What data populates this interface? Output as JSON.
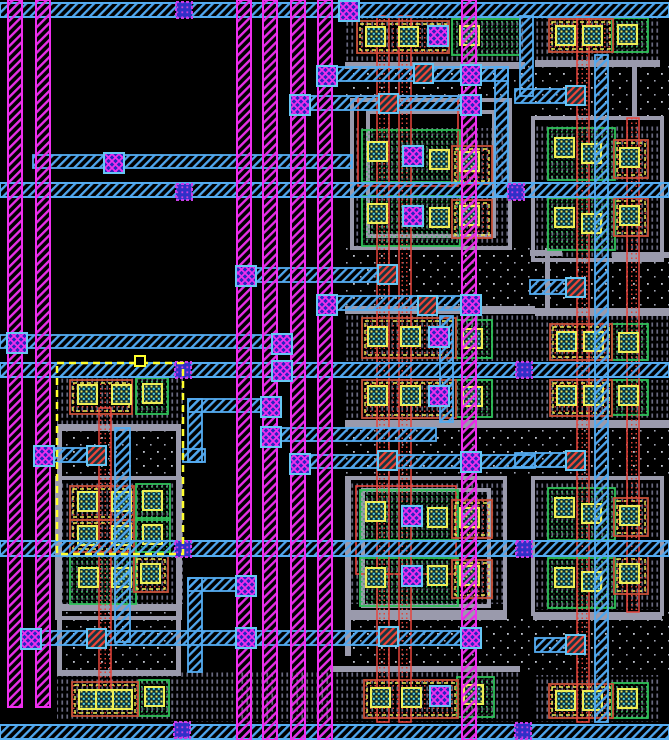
{
  "canvas": {
    "w": 669,
    "h": 740,
    "bg": "#000000"
  },
  "colors": {
    "m1": "#55ACF0",
    "m2": "#EE2EEE",
    "poly": "#E8453C",
    "polyBox": "#C85038",
    "green": "#2EC058",
    "gray": "#9A9AAC",
    "yellow": "#EEEE55",
    "stipple": "#68687E",
    "nwellDot": "#C0C4CE",
    "viaXFill": "#2626BE",
    "viaBorder": "#66C6F4",
    "blueViaFill": "#3030C8",
    "blueViaBorder": "#C83CE8",
    "redContactBase": "#123642",
    "selection": "#FFFF2E"
  },
  "layers": {
    "nwell_regions": [
      {
        "x": 55,
        "y": 430,
        "w": 130,
        "h": 48
      },
      {
        "x": 55,
        "y": 612,
        "w": 130,
        "h": 60
      },
      {
        "x": 345,
        "y": 64,
        "w": 190,
        "h": 36
      },
      {
        "x": 345,
        "y": 248,
        "w": 190,
        "h": 58
      },
      {
        "x": 345,
        "y": 428,
        "w": 190,
        "h": 50
      },
      {
        "x": 345,
        "y": 618,
        "w": 190,
        "h": 54
      },
      {
        "x": 535,
        "y": 64,
        "w": 134,
        "h": 54
      },
      {
        "x": 535,
        "y": 260,
        "w": 134,
        "h": 56
      },
      {
        "x": 535,
        "y": 424,
        "w": 134,
        "h": 54
      },
      {
        "x": 535,
        "y": 612,
        "w": 134,
        "h": 60
      }
    ],
    "stipple_regions": [
      {
        "x": 345,
        "y": 16,
        "w": 180,
        "h": 46
      },
      {
        "x": 535,
        "y": 16,
        "w": 125,
        "h": 46
      },
      {
        "x": 352,
        "y": 128,
        "w": 158,
        "h": 56
      },
      {
        "x": 352,
        "y": 196,
        "w": 158,
        "h": 50
      },
      {
        "x": 533,
        "y": 126,
        "w": 129,
        "h": 58
      },
      {
        "x": 533,
        "y": 196,
        "w": 129,
        "h": 62
      },
      {
        "x": 57,
        "y": 377,
        "w": 126,
        "h": 47
      },
      {
        "x": 345,
        "y": 314,
        "w": 190,
        "h": 47
      },
      {
        "x": 345,
        "y": 380,
        "w": 190,
        "h": 40
      },
      {
        "x": 535,
        "y": 316,
        "w": 134,
        "h": 45
      },
      {
        "x": 535,
        "y": 380,
        "w": 134,
        "h": 44
      },
      {
        "x": 57,
        "y": 482,
        "w": 126,
        "h": 58
      },
      {
        "x": 57,
        "y": 556,
        "w": 126,
        "h": 48
      },
      {
        "x": 347,
        "y": 482,
        "w": 158,
        "h": 57
      },
      {
        "x": 347,
        "y": 558,
        "w": 158,
        "h": 46
      },
      {
        "x": 533,
        "y": 482,
        "w": 129,
        "h": 57
      },
      {
        "x": 533,
        "y": 558,
        "w": 129,
        "h": 52
      },
      {
        "x": 57,
        "y": 676,
        "w": 126,
        "h": 44
      },
      {
        "x": 170,
        "y": 672,
        "w": 350,
        "h": 50
      },
      {
        "x": 535,
        "y": 675,
        "w": 125,
        "h": 47
      }
    ],
    "gray_bars": [
      {
        "x": 345,
        "y": 62,
        "w": 180,
        "h": 7
      },
      {
        "x": 535,
        "y": 60,
        "w": 125,
        "h": 7
      },
      {
        "x": 58,
        "y": 424,
        "w": 120,
        "h": 7
      },
      {
        "x": 345,
        "y": 306,
        "w": 190,
        "h": 8
      },
      {
        "x": 535,
        "y": 308,
        "w": 134,
        "h": 8
      },
      {
        "x": 345,
        "y": 420,
        "w": 190,
        "h": 8
      },
      {
        "x": 535,
        "y": 420,
        "w": 134,
        "h": 8
      },
      {
        "x": 58,
        "y": 604,
        "w": 120,
        "h": 7
      },
      {
        "x": 347,
        "y": 610,
        "w": 158,
        "h": 8
      },
      {
        "x": 533,
        "y": 612,
        "w": 129,
        "h": 8
      },
      {
        "x": 58,
        "y": 670,
        "w": 120,
        "h": 6
      },
      {
        "x": 330,
        "y": 666,
        "w": 190,
        "h": 6
      },
      {
        "x": 57,
        "y": 424,
        "w": 5,
        "h": 252
      },
      {
        "x": 176,
        "y": 424,
        "w": 5,
        "h": 252
      },
      {
        "x": 345,
        "y": 478,
        "w": 6,
        "h": 178
      },
      {
        "x": 612,
        "y": 252,
        "w": 57,
        "h": 6
      },
      {
        "x": 530,
        "y": 250,
        "w": 32,
        "h": 6
      },
      {
        "x": 545,
        "y": 248,
        "w": 5,
        "h": 62
      },
      {
        "x": 632,
        "y": 62,
        "w": 5,
        "h": 56
      }
    ],
    "gray_rects": [
      {
        "x": 352,
        "y": 100,
        "w": 158,
        "h": 148
      },
      {
        "x": 368,
        "y": 112,
        "w": 126,
        "h": 124
      },
      {
        "x": 347,
        "y": 478,
        "w": 158,
        "h": 140
      },
      {
        "x": 363,
        "y": 490,
        "w": 126,
        "h": 116
      },
      {
        "x": 533,
        "y": 118,
        "w": 129,
        "h": 142
      },
      {
        "x": 533,
        "y": 478,
        "w": 129,
        "h": 136
      },
      {
        "x": 57,
        "y": 478,
        "w": 123,
        "h": 140
      }
    ],
    "poly_rects": [
      {
        "x": 358,
        "y": 96,
        "w": 100,
        "h": 90
      },
      {
        "x": 356,
        "y": 486,
        "w": 100,
        "h": 88
      }
    ],
    "green_boxes": [
      {
        "x": 452,
        "y": 19,
        "w": 68,
        "h": 36
      },
      {
        "x": 612,
        "y": 18,
        "w": 36,
        "h": 34
      },
      {
        "x": 362,
        "y": 130,
        "w": 98,
        "h": 52
      },
      {
        "x": 362,
        "y": 196,
        "w": 98,
        "h": 50
      },
      {
        "x": 548,
        "y": 128,
        "w": 67,
        "h": 52
      },
      {
        "x": 548,
        "y": 198,
        "w": 67,
        "h": 52
      },
      {
        "x": 456,
        "y": 320,
        "w": 36,
        "h": 38
      },
      {
        "x": 456,
        "y": 380,
        "w": 36,
        "h": 37
      },
      {
        "x": 612,
        "y": 324,
        "w": 36,
        "h": 36
      },
      {
        "x": 612,
        "y": 380,
        "w": 36,
        "h": 35
      },
      {
        "x": 360,
        "y": 490,
        "w": 98,
        "h": 50
      },
      {
        "x": 360,
        "y": 558,
        "w": 98,
        "h": 48
      },
      {
        "x": 548,
        "y": 488,
        "w": 67,
        "h": 52
      },
      {
        "x": 548,
        "y": 558,
        "w": 67,
        "h": 50
      },
      {
        "x": 457,
        "y": 677,
        "w": 37,
        "h": 40
      },
      {
        "x": 612,
        "y": 683,
        "w": 36,
        "h": 35
      },
      {
        "x": 136,
        "y": 378,
        "w": 32,
        "h": 36
      },
      {
        "x": 136,
        "y": 484,
        "w": 34,
        "h": 36
      },
      {
        "x": 136,
        "y": 518,
        "w": 34,
        "h": 34
      },
      {
        "x": 70,
        "y": 556,
        "w": 66,
        "h": 48
      },
      {
        "x": 139,
        "y": 680,
        "w": 30,
        "h": 36
      }
    ],
    "orange_boxes": [
      {
        "x": 357,
        "y": 21,
        "w": 92,
        "h": 32
      },
      {
        "x": 549,
        "y": 19,
        "w": 64,
        "h": 33
      },
      {
        "x": 452,
        "y": 146,
        "w": 40,
        "h": 38
      },
      {
        "x": 452,
        "y": 200,
        "w": 40,
        "h": 38
      },
      {
        "x": 614,
        "y": 140,
        "w": 34,
        "h": 38
      },
      {
        "x": 614,
        "y": 198,
        "w": 34,
        "h": 38
      },
      {
        "x": 362,
        "y": 318,
        "w": 94,
        "h": 40
      },
      {
        "x": 362,
        "y": 380,
        "w": 94,
        "h": 38
      },
      {
        "x": 550,
        "y": 324,
        "w": 62,
        "h": 36
      },
      {
        "x": 550,
        "y": 380,
        "w": 62,
        "h": 36
      },
      {
        "x": 452,
        "y": 500,
        "w": 40,
        "h": 38
      },
      {
        "x": 452,
        "y": 560,
        "w": 40,
        "h": 38
      },
      {
        "x": 614,
        "y": 498,
        "w": 34,
        "h": 38
      },
      {
        "x": 614,
        "y": 556,
        "w": 34,
        "h": 38
      },
      {
        "x": 364,
        "y": 680,
        "w": 94,
        "h": 38
      },
      {
        "x": 549,
        "y": 684,
        "w": 64,
        "h": 34
      },
      {
        "x": 70,
        "y": 380,
        "w": 62,
        "h": 34
      },
      {
        "x": 70,
        "y": 486,
        "w": 64,
        "h": 34
      },
      {
        "x": 70,
        "y": 520,
        "w": 64,
        "h": 32
      },
      {
        "x": 134,
        "y": 556,
        "w": 34,
        "h": 36
      },
      {
        "x": 72,
        "y": 682,
        "w": 66,
        "h": 34
      }
    ],
    "poly_verticals": [
      {
        "x": 99,
        "y": 408,
        "h": 288
      },
      {
        "x": 377,
        "y": 16,
        "h": 706
      },
      {
        "x": 399,
        "y": 16,
        "h": 706
      },
      {
        "x": 577,
        "y": 16,
        "h": 706
      },
      {
        "x": 627,
        "y": 118,
        "h": 494
      }
    ],
    "contacts": [
      {
        "x": 366,
        "y": 27
      },
      {
        "x": 399,
        "y": 27
      },
      {
        "x": 460,
        "y": 26
      },
      {
        "x": 556,
        "y": 26
      },
      {
        "x": 583,
        "y": 26
      },
      {
        "x": 618,
        "y": 25
      },
      {
        "x": 368,
        "y": 142
      },
      {
        "x": 430,
        "y": 150
      },
      {
        "x": 460,
        "y": 152
      },
      {
        "x": 368,
        "y": 204
      },
      {
        "x": 430,
        "y": 208
      },
      {
        "x": 460,
        "y": 206
      },
      {
        "x": 555,
        "y": 138
      },
      {
        "x": 582,
        "y": 144
      },
      {
        "x": 620,
        "y": 148
      },
      {
        "x": 555,
        "y": 208
      },
      {
        "x": 582,
        "y": 214
      },
      {
        "x": 620,
        "y": 206
      },
      {
        "x": 368,
        "y": 327
      },
      {
        "x": 401,
        "y": 327
      },
      {
        "x": 463,
        "y": 329
      },
      {
        "x": 368,
        "y": 386
      },
      {
        "x": 401,
        "y": 386
      },
      {
        "x": 463,
        "y": 387
      },
      {
        "x": 557,
        "y": 332
      },
      {
        "x": 584,
        "y": 332
      },
      {
        "x": 619,
        "y": 333
      },
      {
        "x": 557,
        "y": 386
      },
      {
        "x": 584,
        "y": 386
      },
      {
        "x": 619,
        "y": 386
      },
      {
        "x": 366,
        "y": 502
      },
      {
        "x": 428,
        "y": 508
      },
      {
        "x": 460,
        "y": 508
      },
      {
        "x": 366,
        "y": 568
      },
      {
        "x": 428,
        "y": 566
      },
      {
        "x": 460,
        "y": 566
      },
      {
        "x": 555,
        "y": 498
      },
      {
        "x": 582,
        "y": 504
      },
      {
        "x": 620,
        "y": 506
      },
      {
        "x": 555,
        "y": 568
      },
      {
        "x": 582,
        "y": 572
      },
      {
        "x": 620,
        "y": 564
      },
      {
        "x": 371,
        "y": 688
      },
      {
        "x": 402,
        "y": 688
      },
      {
        "x": 464,
        "y": 685
      },
      {
        "x": 556,
        "y": 691
      },
      {
        "x": 583,
        "y": 691
      },
      {
        "x": 618,
        "y": 689
      },
      {
        "x": 78,
        "y": 385
      },
      {
        "x": 112,
        "y": 385
      },
      {
        "x": 143,
        "y": 384
      },
      {
        "x": 78,
        "y": 492
      },
      {
        "x": 112,
        "y": 492
      },
      {
        "x": 143,
        "y": 491
      },
      {
        "x": 78,
        "y": 526
      },
      {
        "x": 112,
        "y": 526
      },
      {
        "x": 143,
        "y": 525
      },
      {
        "x": 79,
        "y": 568
      },
      {
        "x": 112,
        "y": 568
      },
      {
        "x": 141,
        "y": 564
      },
      {
        "x": 79,
        "y": 690
      },
      {
        "x": 96,
        "y": 690
      },
      {
        "x": 113,
        "y": 690
      },
      {
        "x": 145,
        "y": 687
      }
    ],
    "m1_bands": [
      {
        "x": 0,
        "y": 3,
        "w": 669,
        "h": 14
      },
      {
        "x": 0,
        "y": 183,
        "w": 669,
        "h": 14
      },
      {
        "x": 0,
        "y": 363,
        "w": 669,
        "h": 14
      },
      {
        "x": 0,
        "y": 541,
        "w": 669,
        "h": 15
      },
      {
        "x": 0,
        "y": 725,
        "w": 669,
        "h": 14
      }
    ],
    "m1_traces": [
      {
        "x": 33,
        "y": 155,
        "w": 319,
        "h": 13
      },
      {
        "x": 318,
        "y": 67,
        "w": 190,
        "h": 14
      },
      {
        "x": 291,
        "y": 96,
        "w": 187,
        "h": 14
      },
      {
        "x": 248,
        "y": 268,
        "w": 148,
        "h": 14
      },
      {
        "x": 318,
        "y": 296,
        "w": 162,
        "h": 14
      },
      {
        "x": 0,
        "y": 335,
        "w": 287,
        "h": 13
      },
      {
        "x": 188,
        "y": 399,
        "w": 89,
        "h": 13
      },
      {
        "x": 262,
        "y": 428,
        "w": 174,
        "h": 13
      },
      {
        "x": 35,
        "y": 448,
        "w": 70,
        "h": 14
      },
      {
        "x": 291,
        "y": 455,
        "w": 244,
        "h": 13
      },
      {
        "x": 183,
        "y": 449,
        "w": 22,
        "h": 13
      },
      {
        "x": 188,
        "y": 578,
        "w": 64,
        "h": 13
      },
      {
        "x": 22,
        "y": 631,
        "w": 455,
        "h": 14
      },
      {
        "x": 515,
        "y": 89,
        "w": 69,
        "h": 14
      },
      {
        "x": 530,
        "y": 280,
        "w": 54,
        "h": 14
      },
      {
        "x": 515,
        "y": 453,
        "w": 69,
        "h": 14
      },
      {
        "x": 535,
        "y": 638,
        "w": 49,
        "h": 14
      }
    ],
    "m1_straps": [
      {
        "x": 115,
        "y": 428,
        "w": 15,
        "h": 214
      },
      {
        "x": 188,
        "y": 399,
        "w": 14,
        "h": 63
      },
      {
        "x": 188,
        "y": 578,
        "w": 14,
        "h": 94
      },
      {
        "x": 495,
        "y": 67,
        "w": 13,
        "h": 129
      },
      {
        "x": 520,
        "y": 16,
        "w": 13,
        "h": 80
      },
      {
        "x": 595,
        "y": 55,
        "w": 13,
        "h": 667
      },
      {
        "x": 440,
        "y": 316,
        "w": 13,
        "h": 106
      }
    ],
    "m2_stripes": [
      {
        "x": 8,
        "y": 0,
        "w": 14,
        "h": 707
      },
      {
        "x": 36,
        "y": 0,
        "w": 14,
        "h": 707
      },
      {
        "x": 237,
        "y": 0,
        "w": 14,
        "h": 740
      },
      {
        "x": 263,
        "y": 0,
        "w": 14,
        "h": 740
      },
      {
        "x": 291,
        "y": 0,
        "w": 14,
        "h": 740
      },
      {
        "x": 318,
        "y": 0,
        "w": 14,
        "h": 740
      },
      {
        "x": 462,
        "y": 0,
        "w": 14,
        "h": 740
      }
    ],
    "red_contacts": [
      {
        "x": 414,
        "y": 64
      },
      {
        "x": 379,
        "y": 94
      },
      {
        "x": 378,
        "y": 265
      },
      {
        "x": 418,
        "y": 296
      },
      {
        "x": 87,
        "y": 446
      },
      {
        "x": 378,
        "y": 451
      },
      {
        "x": 87,
        "y": 629
      },
      {
        "x": 379,
        "y": 627
      },
      {
        "x": 566,
        "y": 86
      },
      {
        "x": 566,
        "y": 278
      },
      {
        "x": 566,
        "y": 451
      },
      {
        "x": 566,
        "y": 635
      }
    ],
    "vias_x": [
      {
        "x": 428,
        "y": 26
      },
      {
        "x": 339,
        "y": 1
      },
      {
        "x": 317,
        "y": 66
      },
      {
        "x": 290,
        "y": 95
      },
      {
        "x": 461,
        "y": 65
      },
      {
        "x": 461,
        "y": 95
      },
      {
        "x": 236,
        "y": 266
      },
      {
        "x": 317,
        "y": 295
      },
      {
        "x": 461,
        "y": 295
      },
      {
        "x": 7,
        "y": 333
      },
      {
        "x": 272,
        "y": 334
      },
      {
        "x": 272,
        "y": 361
      },
      {
        "x": 261,
        "y": 397
      },
      {
        "x": 261,
        "y": 427
      },
      {
        "x": 34,
        "y": 446
      },
      {
        "x": 290,
        "y": 454
      },
      {
        "x": 461,
        "y": 452
      },
      {
        "x": 403,
        "y": 146
      },
      {
        "x": 403,
        "y": 206
      },
      {
        "x": 429,
        "y": 327
      },
      {
        "x": 429,
        "y": 386
      },
      {
        "x": 402,
        "y": 506
      },
      {
        "x": 402,
        "y": 566
      },
      {
        "x": 236,
        "y": 576
      },
      {
        "x": 21,
        "y": 629
      },
      {
        "x": 236,
        "y": 628
      },
      {
        "x": 461,
        "y": 628
      },
      {
        "x": 430,
        "y": 686
      },
      {
        "x": 104,
        "y": 153
      }
    ],
    "vias_blue": [
      {
        "x": 176,
        "y": 2
      },
      {
        "x": 176,
        "y": 184
      },
      {
        "x": 508,
        "y": 184
      },
      {
        "x": 175,
        "y": 362
      },
      {
        "x": 516,
        "y": 362
      },
      {
        "x": 175,
        "y": 541
      },
      {
        "x": 516,
        "y": 541
      },
      {
        "x": 174,
        "y": 722
      },
      {
        "x": 515,
        "y": 723
      }
    ],
    "selection": {
      "x": 57,
      "y": 363,
      "w": 126,
      "h": 191,
      "marker": {
        "x": 135,
        "y": 356,
        "s": 10
      }
    }
  }
}
